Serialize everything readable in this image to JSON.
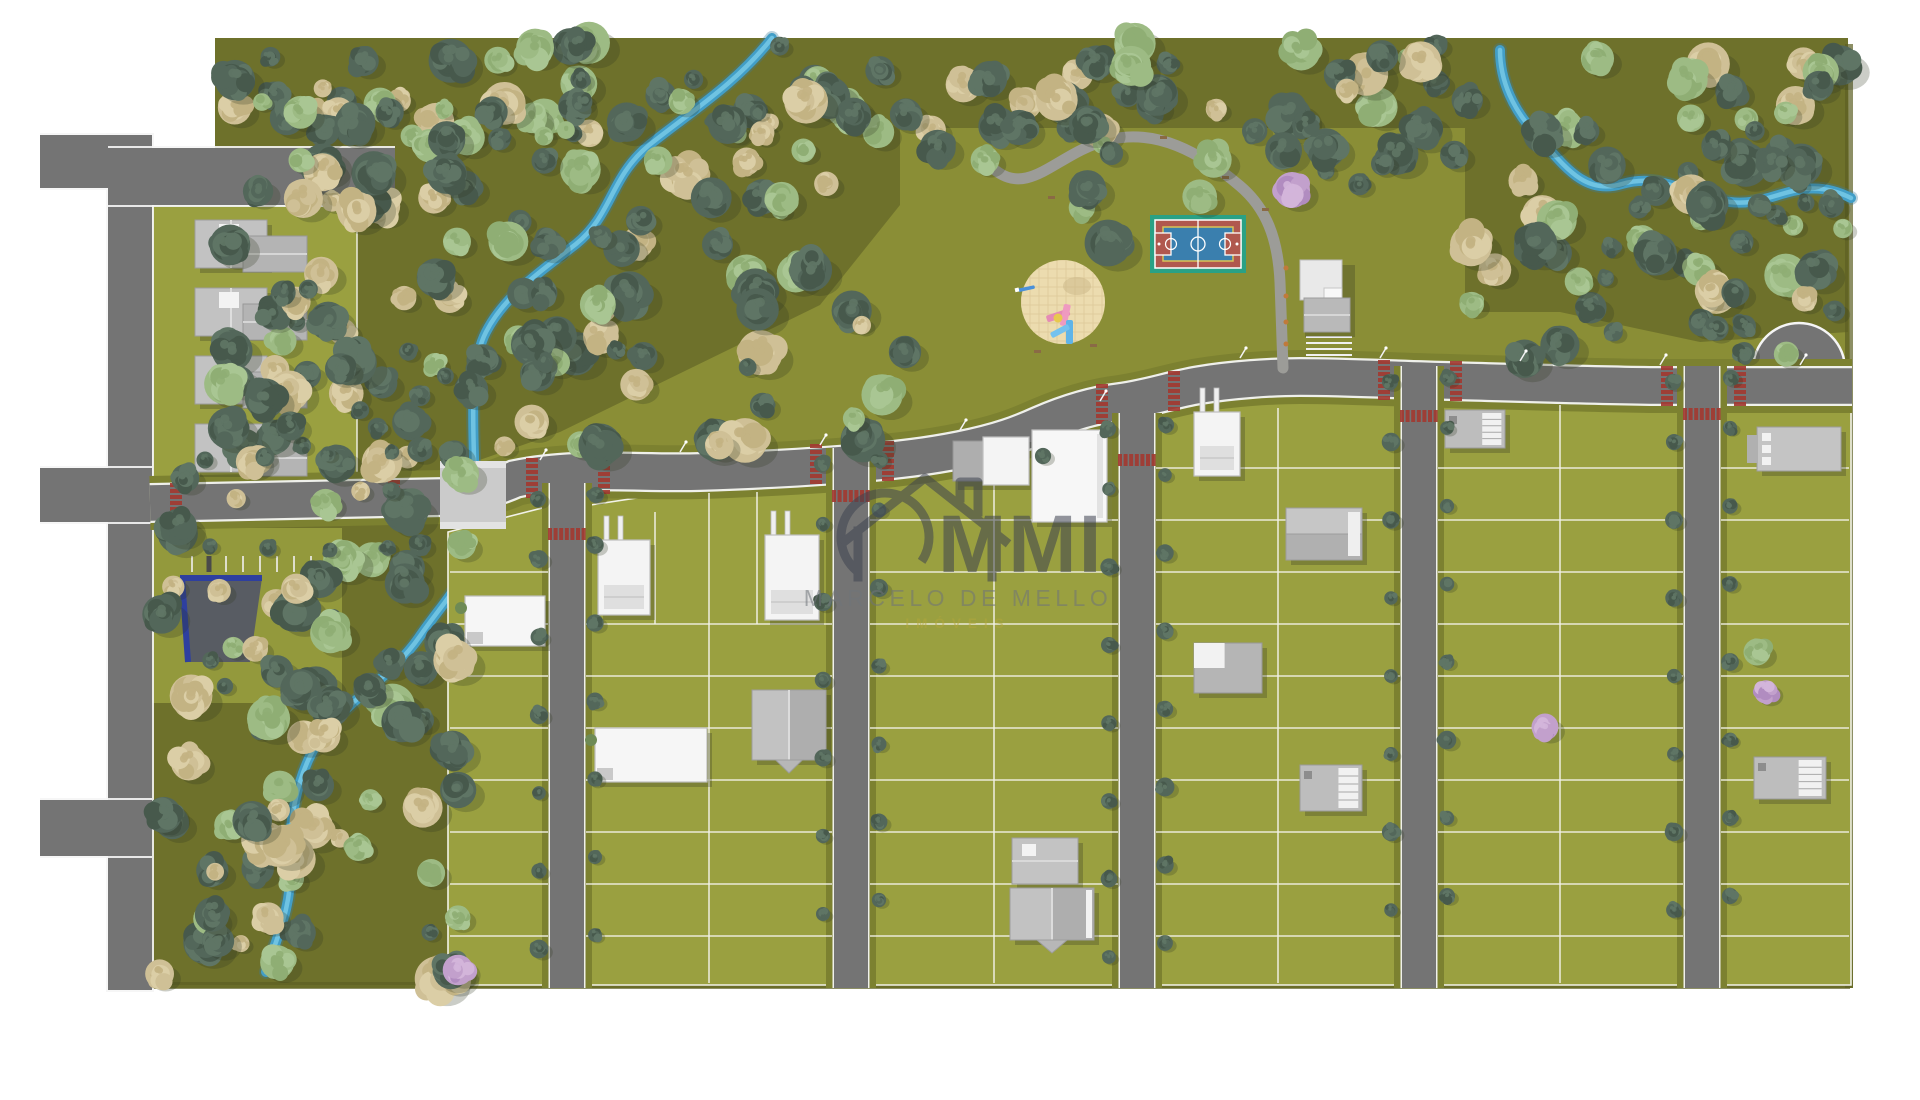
{
  "watermark": {
    "logo_text": "MMI",
    "line1": "MARCELO DE MELLO",
    "line2": "IMÓVEIS",
    "logo_color": "#3e4350",
    "line1_color": "#6f747a",
    "line2_color": "#b3a73d"
  },
  "colors": {
    "background": "#ffffff",
    "lawn": "#8a8e36",
    "forest_floor": "#6e712b",
    "lot": "#9aa040",
    "verge": "#7c8130",
    "road": "#747474",
    "road_edge": "#f5f5f5",
    "path": "#9c9c98",
    "bridge": "#cbcbcb",
    "stream_outer": "#429ec7",
    "stream_inner": "#6fc3e2",
    "crosswalk_red": "#a23a31",
    "lot_line": "#f2f2e8",
    "edge_shadow": "#5d6024",
    "court_green": "#2aa185",
    "court_red": "#b0584e",
    "court_blue": "#3a7fae",
    "court_yellow": "#d9c355",
    "sand": "#ecdcaf",
    "sand_grid": "#dfcc9c",
    "blue_roof": "#2e3f9f",
    "tree_dark": [
      "#53675a",
      "#47594c",
      "#5f7565"
    ],
    "tree_light": [
      "#9dbb84",
      "#a9c693",
      "#8fae74"
    ],
    "tree_tan": [
      "#cfc096",
      "#dbcea6",
      "#c3b383"
    ],
    "tree_lilac": [
      "#c2a0cc",
      "#b18cc0",
      "#d3b5da"
    ],
    "bench": "#8a6a45"
  },
  "scene": {
    "footprint": "M215,38 L1848,38 L1853,988 L150,988 L150,148 L215,148 Z",
    "forest_floors": [
      "M215,38 L900,38 L900,205 L820,305 L560,432 L445,472 L215,472 Z",
      "M900,38 L1465,38 L1465,128 L900,128 Z",
      "M1465,38 L1848,38 L1848,332 L1700,342 L1560,312 L1465,312 Z",
      "M152,470 L460,470 L470,985 L152,985 Z"
    ],
    "edge_shadows": [
      {
        "x": 150,
        "y": 982,
        "w": 1700,
        "h": 7
      },
      {
        "x": 1845,
        "y": 44,
        "w": 8,
        "h": 944
      }
    ],
    "streams": [
      "M772,38 C735,85 690,112 648,146 C610,178 612,215 576,244 C540,272 505,295 486,332 C470,363 473,415 474,458 L474,532 C474,574 446,598 420,636 C390,680 345,700 318,742 C295,778 288,828 290,868 C292,908 276,938 266,972",
      "M1851,198 C1800,172 1772,208 1730,202 C1688,196 1662,172 1622,184 C1582,196 1562,162 1534,132 C1514,110 1500,82 1500,50"
    ],
    "main_road": "M150,503 L445,497 C470,494 495,488 515,479 C575,466 640,474 700,472 C760,470 800,468 850,464 C900,460 930,456 960,450 C1000,442 1020,434 1040,425 C1070,412 1095,405 1120,402 C1150,398 1170,390 1200,385 C1230,380 1270,377 1300,377 C1350,377 1400,380 1450,381 C1520,383 1580,385 1650,386 L1852,386",
    "culdesac": {
      "cx": 1799,
      "cy": 383,
      "r": 46
    },
    "bridge": {
      "x": 440,
      "y": 461,
      "w": 66,
      "h": 68
    },
    "left_road": {
      "vertical": {
        "x": 108,
        "y": 135,
        "w": 44,
        "h": 855
      },
      "stubs": [
        {
          "x": 40,
          "y": 135,
          "w": 112,
          "h": 53
        },
        {
          "x": 40,
          "y": 468,
          "w": 112,
          "h": 54
        },
        {
          "x": 40,
          "y": 800,
          "w": 112,
          "h": 56
        }
      ],
      "top_road": {
        "x": 108,
        "y": 148,
        "w": 287,
        "h": 57
      }
    },
    "amenity_path": "M995,170 C1030,198 1058,152 1108,140 C1156,128 1200,152 1240,186 C1266,208 1278,238 1280,282 L1283,368",
    "benches": [
      [
        1048,
        196
      ],
      [
        1106,
        130
      ],
      [
        1160,
        136
      ],
      [
        1222,
        176
      ],
      [
        1262,
        208
      ],
      [
        1034,
        350
      ],
      [
        1090,
        344
      ]
    ],
    "bollards": [
      [
        1286,
        268
      ],
      [
        1286,
        296
      ],
      [
        1286,
        322
      ],
      [
        1286,
        344
      ]
    ],
    "streets": [
      {
        "x": 550,
        "top": 483
      },
      {
        "x": 834,
        "top": 448
      },
      {
        "x": 1120,
        "top": 413
      },
      {
        "x": 1402,
        "top": 366
      },
      {
        "x": 1685,
        "top": 366
      }
    ],
    "street_w": 34,
    "blocks": [
      {
        "x1": 448,
        "x2": 550,
        "tl": 532,
        "tr": 506,
        "cx": null,
        "hl": [
          572,
          624,
          676,
          728,
          780,
          832,
          884,
          936
        ],
        "vl": []
      },
      {
        "x1": 584,
        "x2": 834,
        "tl": 506,
        "tr": 468,
        "cx": 709,
        "hl": [
          624,
          676,
          728,
          780,
          832,
          884,
          936
        ],
        "vl": [
          [
            655,
            512,
            624
          ],
          [
            757,
            492,
            624
          ]
        ]
      },
      {
        "x1": 868,
        "x2": 1120,
        "tl": 462,
        "tr": 426,
        "cx": 994,
        "hl": [
          520,
          572,
          624,
          676,
          728,
          780,
          832,
          884,
          936
        ],
        "vl": []
      },
      {
        "x1": 1154,
        "x2": 1402,
        "tl": 408,
        "tr": 396,
        "cx": 1278,
        "hl": [
          468,
          520,
          572,
          624,
          676,
          728,
          780,
          832,
          884,
          936
        ],
        "vl": []
      },
      {
        "x1": 1436,
        "x2": 1685,
        "tl": 398,
        "tr": 400,
        "cx": 1560,
        "hl": [
          468,
          520,
          572,
          624,
          676,
          728,
          780,
          832,
          884,
          936
        ],
        "vl": []
      },
      {
        "x1": 1719,
        "x2": 1851,
        "tl": 404,
        "tr": 408,
        "cx": null,
        "hl": [
          468,
          520,
          572,
          624,
          676,
          728,
          780,
          832,
          884,
          936
        ],
        "vl": []
      }
    ],
    "crosswalks_road": [
      [
        176,
        503
      ],
      [
        394,
        500
      ],
      [
        532,
        478
      ],
      [
        604,
        474
      ],
      [
        816,
        464
      ],
      [
        888,
        461
      ],
      [
        1102,
        404
      ],
      [
        1174,
        391
      ],
      [
        1384,
        380
      ],
      [
        1456,
        381
      ],
      [
        1667,
        386
      ],
      [
        1740,
        386
      ]
    ],
    "crosswalks_street": [
      [
        567,
        534
      ],
      [
        851,
        496
      ],
      [
        1137,
        460
      ],
      [
        1419,
        416
      ],
      [
        1702,
        414
      ]
    ],
    "parking_ticks": {
      "x0": 192,
      "step": 17,
      "n": 8,
      "y": 556,
      "h": 16,
      "hatch_index": 1
    },
    "club_parking": {
      "x": 1306,
      "y": 336,
      "w": 46,
      "rows": 4,
      "gap": 6
    },
    "court": {
      "x": 1150,
      "y": 215,
      "w": 96,
      "h": 58
    },
    "playground": {
      "cx": 1063,
      "cy": 302,
      "r": 42
    },
    "houses": [
      {
        "type": "gableTL",
        "x": 195,
        "y": 220
      },
      {
        "type": "gableTL",
        "x": 195,
        "y": 288
      },
      {
        "type": "gableTL",
        "x": 195,
        "y": 356
      },
      {
        "type": "gableTL",
        "x": 195,
        "y": 424
      },
      {
        "type": "blueRoof",
        "x": 180,
        "y": 578
      },
      {
        "type": "flatWhite",
        "x": 465,
        "y": 596,
        "w": 80,
        "h": 50
      },
      {
        "type": "modern",
        "x": 598,
        "y": 540,
        "w": 52,
        "h": 75
      },
      {
        "type": "modern",
        "x": 765,
        "y": 535,
        "w": 54,
        "h": 85
      },
      {
        "type": "flatWhite",
        "x": 595,
        "y": 728,
        "w": 112,
        "h": 54
      },
      {
        "type": "gableV",
        "x": 752,
        "y": 690,
        "w": 74,
        "h": 70
      },
      {
        "type": "garageHouse",
        "x": 953,
        "y": 437,
        "w": 76,
        "h": 48
      },
      {
        "type": "bigWhite",
        "x": 1032,
        "y": 430,
        "w": 75,
        "h": 92
      },
      {
        "type": "gableSpeck",
        "x": 1012,
        "y": 838,
        "w": 66,
        "h": 46
      },
      {
        "type": "gableV",
        "x": 1010,
        "y": 888,
        "w": 84,
        "h": 52,
        "trim": true
      },
      {
        "type": "modern",
        "x": 1194,
        "y": 412,
        "w": 46,
        "h": 64
      },
      {
        "type": "gableH",
        "x": 1286,
        "y": 508,
        "w": 76,
        "h": 52
      },
      {
        "type": "mixed",
        "x": 1194,
        "y": 643,
        "w": 68,
        "h": 50
      },
      {
        "type": "stairs",
        "x": 1300,
        "y": 765,
        "w": 62,
        "h": 46
      },
      {
        "type": "stairs",
        "x": 1445,
        "y": 410,
        "w": 60,
        "h": 38
      },
      {
        "type": "flatGray",
        "x": 1757,
        "y": 427,
        "w": 84,
        "h": 44
      },
      {
        "type": "stairs",
        "x": 1754,
        "y": 757,
        "w": 72,
        "h": 42
      },
      {
        "type": "clubhouse",
        "x": 1300,
        "y": 260
      }
    ],
    "tree_regions": [
      {
        "x": 218,
        "y": 42,
        "w": 1240,
        "h": 95,
        "n": 75,
        "mix": [
          0.5,
          0.25,
          0.25
        ]
      },
      {
        "x": 218,
        "y": 100,
        "w": 650,
        "h": 270,
        "n": 100,
        "mix": [
          0.55,
          0.18,
          0.27
        ]
      },
      {
        "x": 222,
        "y": 360,
        "w": 330,
        "h": 105,
        "n": 32,
        "mix": [
          0.6,
          0.15,
          0.25
        ]
      },
      {
        "x": 1465,
        "y": 58,
        "w": 380,
        "h": 255,
        "n": 62,
        "mix": [
          0.5,
          0.25,
          0.25
        ]
      },
      {
        "x": 900,
        "y": 95,
        "w": 560,
        "h": 115,
        "n": 20,
        "mix": [
          0.45,
          0.3,
          0.25
        ],
        "excl": true
      },
      {
        "x": 158,
        "y": 450,
        "w": 305,
        "h": 530,
        "n": 85,
        "mix": [
          0.55,
          0.2,
          0.25
        ]
      },
      {
        "x": 1470,
        "y": 300,
        "w": 340,
        "h": 70,
        "n": 9,
        "mix": [
          0.4,
          0.4,
          0.2
        ]
      },
      {
        "x": 555,
        "y": 380,
        "w": 330,
        "h": 70,
        "n": 10,
        "mix": [
          0.5,
          0.25,
          0.25
        ]
      }
    ],
    "exclusions": {
      "rects": [
        [
          1135,
          200,
          130,
          85
        ],
        [
          1285,
          248,
          115,
          115
        ]
      ],
      "circles": [
        [
          1063,
          302,
          58
        ]
      ]
    },
    "special_trees": [
      {
        "x": 1108,
        "y": 243,
        "r": 26,
        "p": "d"
      },
      {
        "x": 1326,
        "y": 148,
        "r": 22,
        "p": "d"
      },
      {
        "x": 1043,
        "y": 456,
        "r": 9,
        "p": "d"
      },
      {
        "x": 1757,
        "y": 652,
        "r": 15,
        "p": "l"
      },
      {
        "x": 905,
        "y": 352,
        "r": 18,
        "p": "d"
      },
      {
        "x": 985,
        "y": 160,
        "r": 16,
        "p": "l"
      }
    ],
    "lilac_trees": [
      {
        "x": 1292,
        "y": 190,
        "r": 20
      },
      {
        "x": 1545,
        "y": 727,
        "r": 15
      },
      {
        "x": 1766,
        "y": 692,
        "r": 13
      },
      {
        "x": 458,
        "y": 970,
        "r": 17
      }
    ],
    "road_side_trees": [
      [
        205,
        460
      ],
      [
        265,
        457
      ],
      [
        328,
        454
      ],
      [
        392,
        452
      ],
      [
        210,
        546
      ],
      [
        268,
        548
      ],
      [
        330,
        550
      ],
      [
        388,
        548
      ]
    ],
    "lamps": [
      [
        540,
        460
      ],
      [
        680,
        452
      ],
      [
        820,
        445
      ],
      [
        960,
        430
      ],
      [
        1100,
        401
      ],
      [
        1240,
        358
      ],
      [
        1380,
        358
      ],
      [
        1520,
        361
      ],
      [
        1660,
        365
      ],
      [
        1800,
        365
      ]
    ]
  }
}
